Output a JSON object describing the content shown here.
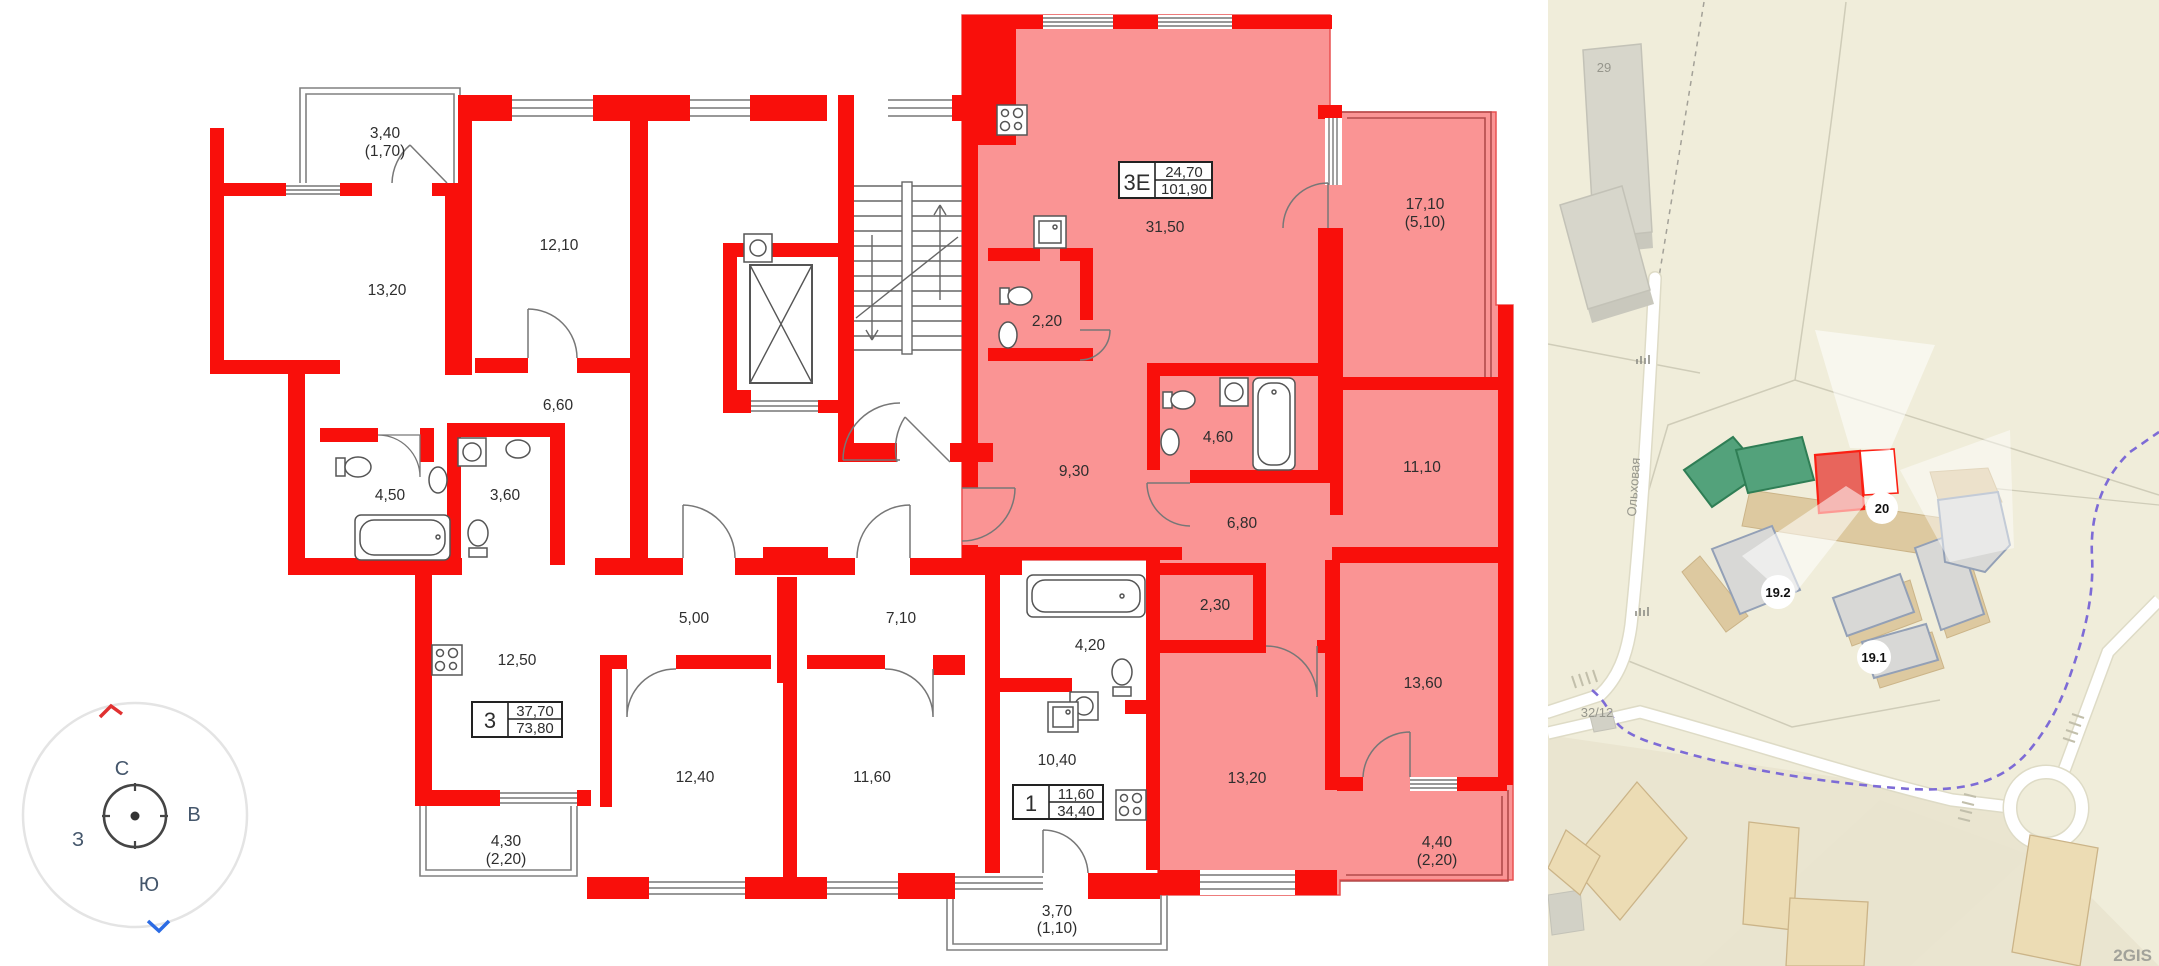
{
  "floorplan": {
    "highlight_color": "#fa9494",
    "wall_color": "#f90f0b",
    "apartments": [
      {
        "code": "3Е",
        "living_area": "24,70",
        "total_area": "101,90"
      },
      {
        "code": "3",
        "living_area": "37,70",
        "total_area": "73,80"
      },
      {
        "code": "1",
        "living_area": "11,60",
        "total_area": "34,40"
      }
    ],
    "rooms": [
      {
        "label": "3,40",
        "sub": "(1,70)"
      },
      {
        "label": "13,20"
      },
      {
        "label": "12,10"
      },
      {
        "label": "6,60"
      },
      {
        "label": "4,50"
      },
      {
        "label": "3,60"
      },
      {
        "label": "12,50"
      },
      {
        "label": "4,30",
        "sub": "(2,20)"
      },
      {
        "label": "12,40"
      },
      {
        "label": "11,60"
      },
      {
        "label": "5,00"
      },
      {
        "label": "7,10"
      },
      {
        "label": "4,20"
      },
      {
        "label": "10,40"
      },
      {
        "label": "3,70",
        "sub": "(1,10)"
      },
      {
        "label": "31,50"
      },
      {
        "label": "2,20"
      },
      {
        "label": "9,30"
      },
      {
        "label": "4,60"
      },
      {
        "label": "6,80"
      },
      {
        "label": "11,10"
      },
      {
        "label": "17,10",
        "sub": "(5,10)"
      },
      {
        "label": "2,30"
      },
      {
        "label": "13,60"
      },
      {
        "label": "13,20"
      },
      {
        "label": "4,40",
        "sub": "(2,20)"
      }
    ]
  },
  "compass": {
    "n": "С",
    "e": "В",
    "w": "З",
    "s": "Ю"
  },
  "map": {
    "building29": "29",
    "plot_label": "32/12",
    "street": "Ольховая",
    "badges": [
      {
        "text": "20"
      },
      {
        "text": "19.2"
      },
      {
        "text": "19.1"
      }
    ],
    "attribution": "2GIS"
  }
}
